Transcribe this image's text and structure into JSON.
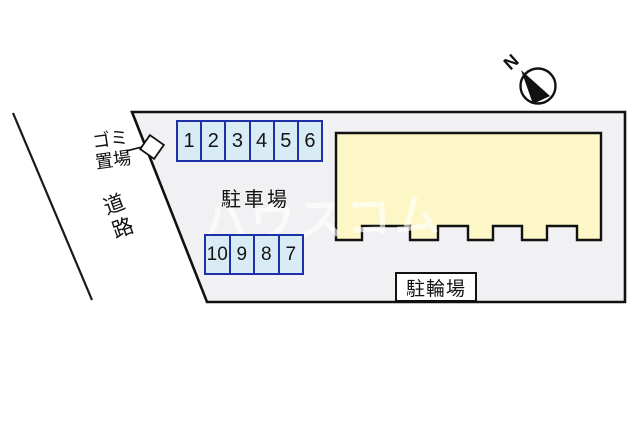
{
  "diagram": {
    "type": "site-plan",
    "watermark": "ハウスコム",
    "north_label": "N",
    "road_label": "道路",
    "garbage_area": {
      "line1": "ゴミ",
      "line2": "置場"
    },
    "parking_lot_label": "駐車場",
    "bicycle_parking_label": "駐輪場",
    "parking_rows": {
      "row1": {
        "stalls": [
          "1",
          "2",
          "3",
          "4",
          "5",
          "6"
        ]
      },
      "row2": {
        "stalls": [
          "10",
          "9",
          "8",
          "7"
        ]
      }
    },
    "colors": {
      "plot_fill": "#f1f1f4",
      "building_fill": "#fdf7c7",
      "stall_fill": "#d9ecf6",
      "stall_border": "#1f31a8",
      "outline": "#111111",
      "marker_fill": "#ffffff"
    }
  }
}
